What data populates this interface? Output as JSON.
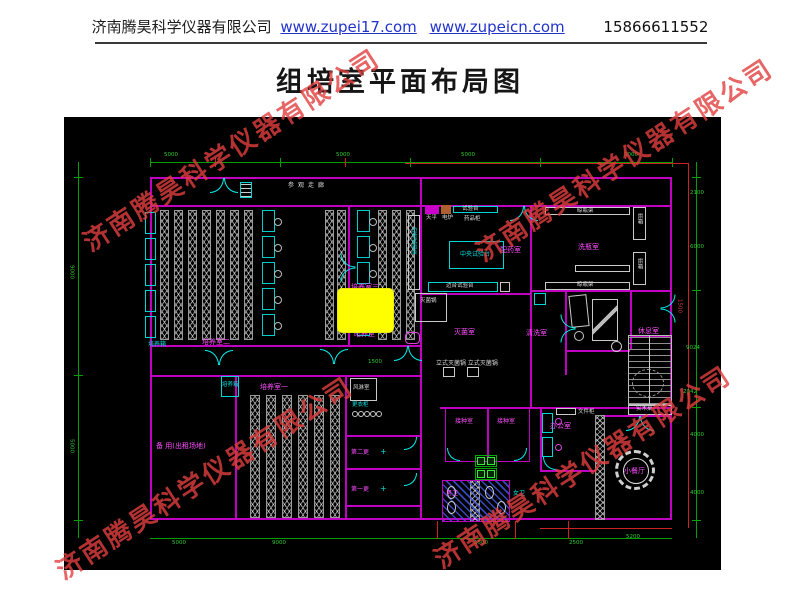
{
  "header": {
    "company": "济南腾昊科学仪器有限公司",
    "link1": "www.zupei17.com",
    "link2": "www.zupeicn.com",
    "phone": "15866611552"
  },
  "title": "组培室平面布局图",
  "watermark": "济南腾昊科学仪器有限公司",
  "plan": {
    "rooms": {
      "corridor": "参观走廊",
      "culture1": "培养室一",
      "culture2": "培养室二",
      "culture3": "培养室三",
      "dark": "暗养室",
      "spare": "备 用(出租场地)",
      "sterilroom": "灭菌室",
      "washroom": "清洗室",
      "pharmacy": "配药室",
      "bottlewash": "洗瓶室",
      "rest": "休息室",
      "office": "办公室",
      "dining": "小餐厅",
      "inoc1": "接种室",
      "inoc2": "接种室",
      "change2": "第二更",
      "change1": "第一更",
      "wcM": "男卫",
      "wcF": "女卫",
      "airshower": "风淋室"
    },
    "equip": {
      "incubatorA": "培养箱",
      "incubatorB": "培养箱",
      "centerBench": "中央试验台",
      "sideBenchV": "边台试验台",
      "sideBenchH": "边台试验台",
      "benchTop": "试验台",
      "balance": "天平",
      "stove": "电炉",
      "medCabinet": "药品柜",
      "rackTop": "晾瓶架",
      "rackBottom": "晾瓶架",
      "oven1": "烘箱",
      "oven2": "烘箱",
      "sterilizer": "灭菌锅",
      "autoclaves": "立式灭菌锅 立式灭菌锅",
      "locker": "更衣柜",
      "fileCabinet": "文件柜",
      "woodTable": "实木桌",
      "plus1": "+",
      "plus2": "+"
    },
    "dims": {
      "top": [
        "5000",
        "5000",
        "5000",
        "3000"
      ],
      "left": [
        "9000",
        "5000"
      ],
      "right": [
        "2100",
        "6000",
        "1500",
        "9024",
        "2042",
        "4000",
        "4000"
      ],
      "bottom": [
        "5000",
        "9000",
        "1500",
        "2500",
        "5200"
      ],
      "inner": [
        "1500"
      ]
    },
    "colors": {
      "wall": "#c000c0",
      "dim_green": "#00a000",
      "dim_red": "#cc2222",
      "label_magenta": "#ff4dff",
      "cyan": "#00e0e0",
      "highlight_yellow": "#ffff00",
      "watermark_red": "#e03e3e",
      "link_blue": "#2233cc",
      "canvas_bg": "#000000"
    }
  }
}
